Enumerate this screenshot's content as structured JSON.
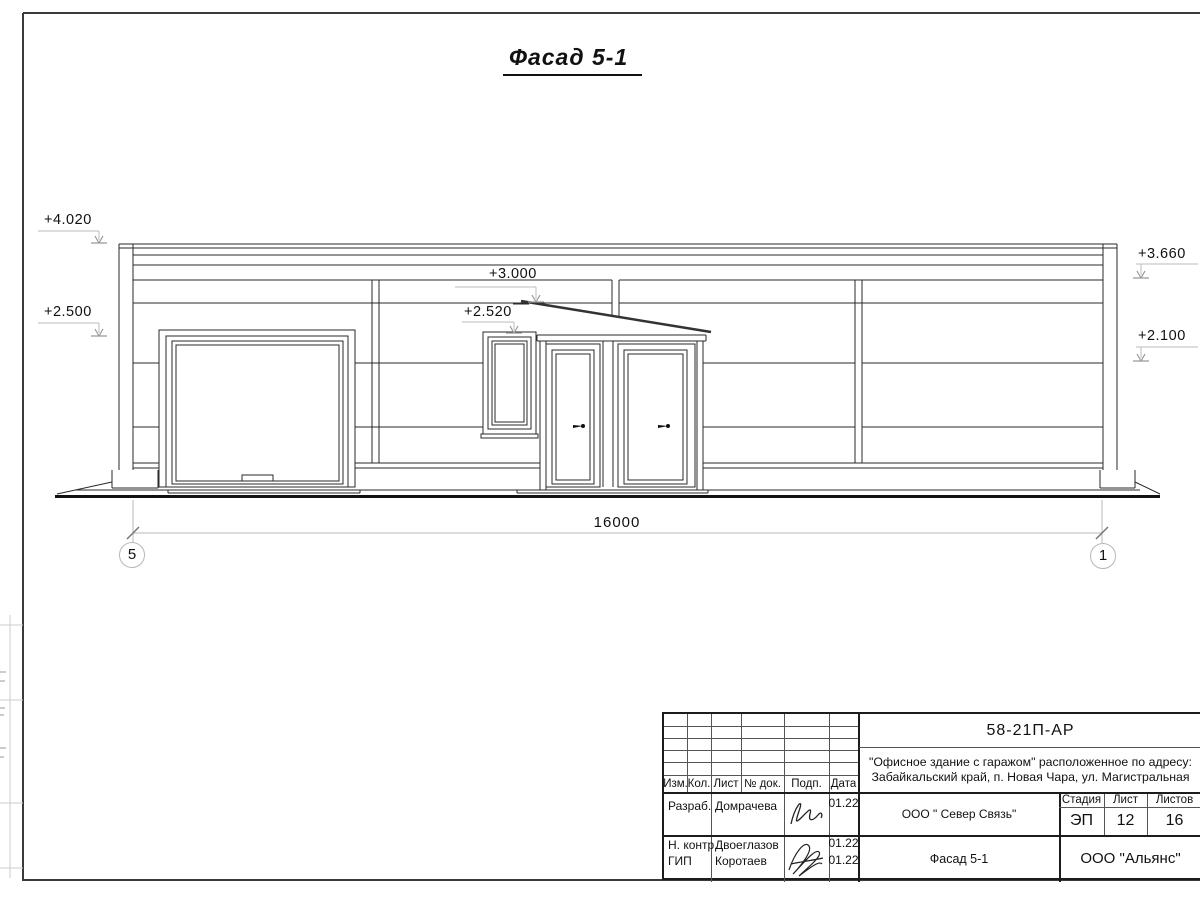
{
  "sheet": {
    "title": "Фасад 5-1"
  },
  "marks": {
    "left_top": "+4.020",
    "left_bottom": "+2.500",
    "mid_top": "+3.000",
    "mid_bottom": "+2.520",
    "right_top": "+3.660",
    "right_bottom": "+2.100"
  },
  "dimension": {
    "total": "16000"
  },
  "axes": {
    "left": "5",
    "right": "1"
  },
  "title_block": {
    "doc_number": "58-21П-АР",
    "project_line1": "\"Офисное здание с гаражом\" расположенное по адресу:",
    "project_line2": "Забайкальский край, п. Новая Чара, ул. Магистральная",
    "columns": {
      "izm": "Изм.",
      "kol": "Кол.",
      "list": "Лист",
      "doc": "№ док.",
      "podp": "Подп.",
      "data": "Дата"
    },
    "rows": [
      {
        "role": "Разраб.",
        "name": "Домрачева",
        "date": "01.22"
      },
      {
        "role": "Н. контр.",
        "name": "Двоеглазов",
        "date": "01.22"
      },
      {
        "role": "ГИП",
        "name": "Коротаев",
        "date": "01.22"
      }
    ],
    "org": "ООО \" Север Связь\"",
    "stage_label": "Стадия",
    "sheet_label": "Лист",
    "sheets_label": "Листов",
    "stage": "ЭП",
    "sheet_no": "12",
    "sheets_total": "16",
    "sheet_title": "Фасад 5-1",
    "company": "ООО \"Альянс\""
  }
}
